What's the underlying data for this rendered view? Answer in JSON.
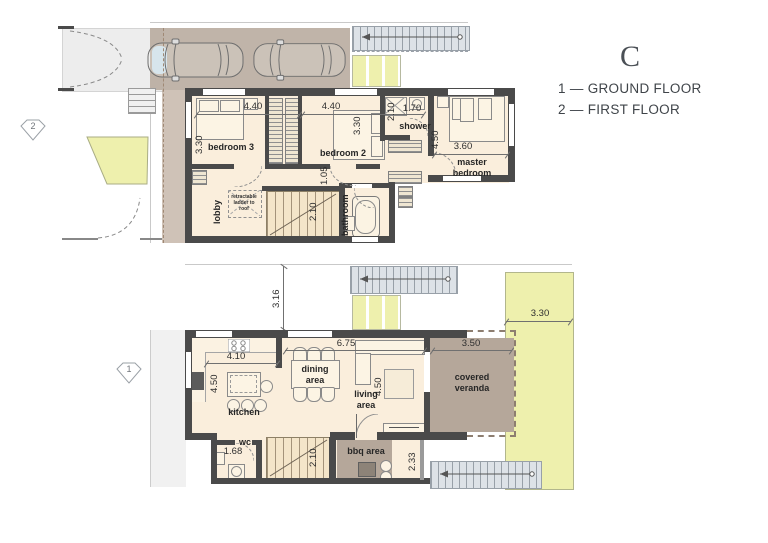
{
  "legend": {
    "title": "C",
    "ground": "1 — GROUND FLOOR",
    "first": "2 — FIRST FLOOR"
  },
  "markers": {
    "ground_floor": "1",
    "first_floor": "2"
  },
  "first_floor": {
    "rooms": {
      "bedroom3": "bedroom 3",
      "bedroom2": "bedroom 2",
      "master_bedroom": "master bedroom",
      "shower": "shower",
      "lobby": "lobby",
      "bathroom": "bathroom",
      "ladder_note": "retractable ladder to roof"
    },
    "dims": {
      "bedroom3_width": "4.40",
      "bedroom2_width": "4.40",
      "bedroom3_depth": "3.30",
      "bedroom2_depth": "3.30",
      "hall_width": "1.05",
      "shower_depth": "2.10",
      "shower_width": "1.70",
      "master_depth": "4.50",
      "master_width": "3.60",
      "stairs_width": "2.10"
    }
  },
  "ground_floor": {
    "rooms": {
      "kitchen": "kitchen",
      "dining": "dining area",
      "living": "living area",
      "veranda": "covered veranda",
      "wc": "wc",
      "bbq": "bbq area"
    },
    "dims": {
      "kitchen_width": "4.10",
      "kitchen_depth": "4.50",
      "dining_width": "6.75",
      "living_depth": "4.50",
      "veranda_width": "3.50",
      "garden_width": "3.30",
      "side_setback": "3.16",
      "wc_width": "1.68",
      "stairs_width": "2.10",
      "right_setback": "2.33"
    }
  },
  "colors": {
    "floor": "#faeedc",
    "wall": "#4a4a4a",
    "greenery": "#eef0ad",
    "paving": "#ededed",
    "terrace": "#b5a79a",
    "stair_hatch": "#dde2e7"
  }
}
